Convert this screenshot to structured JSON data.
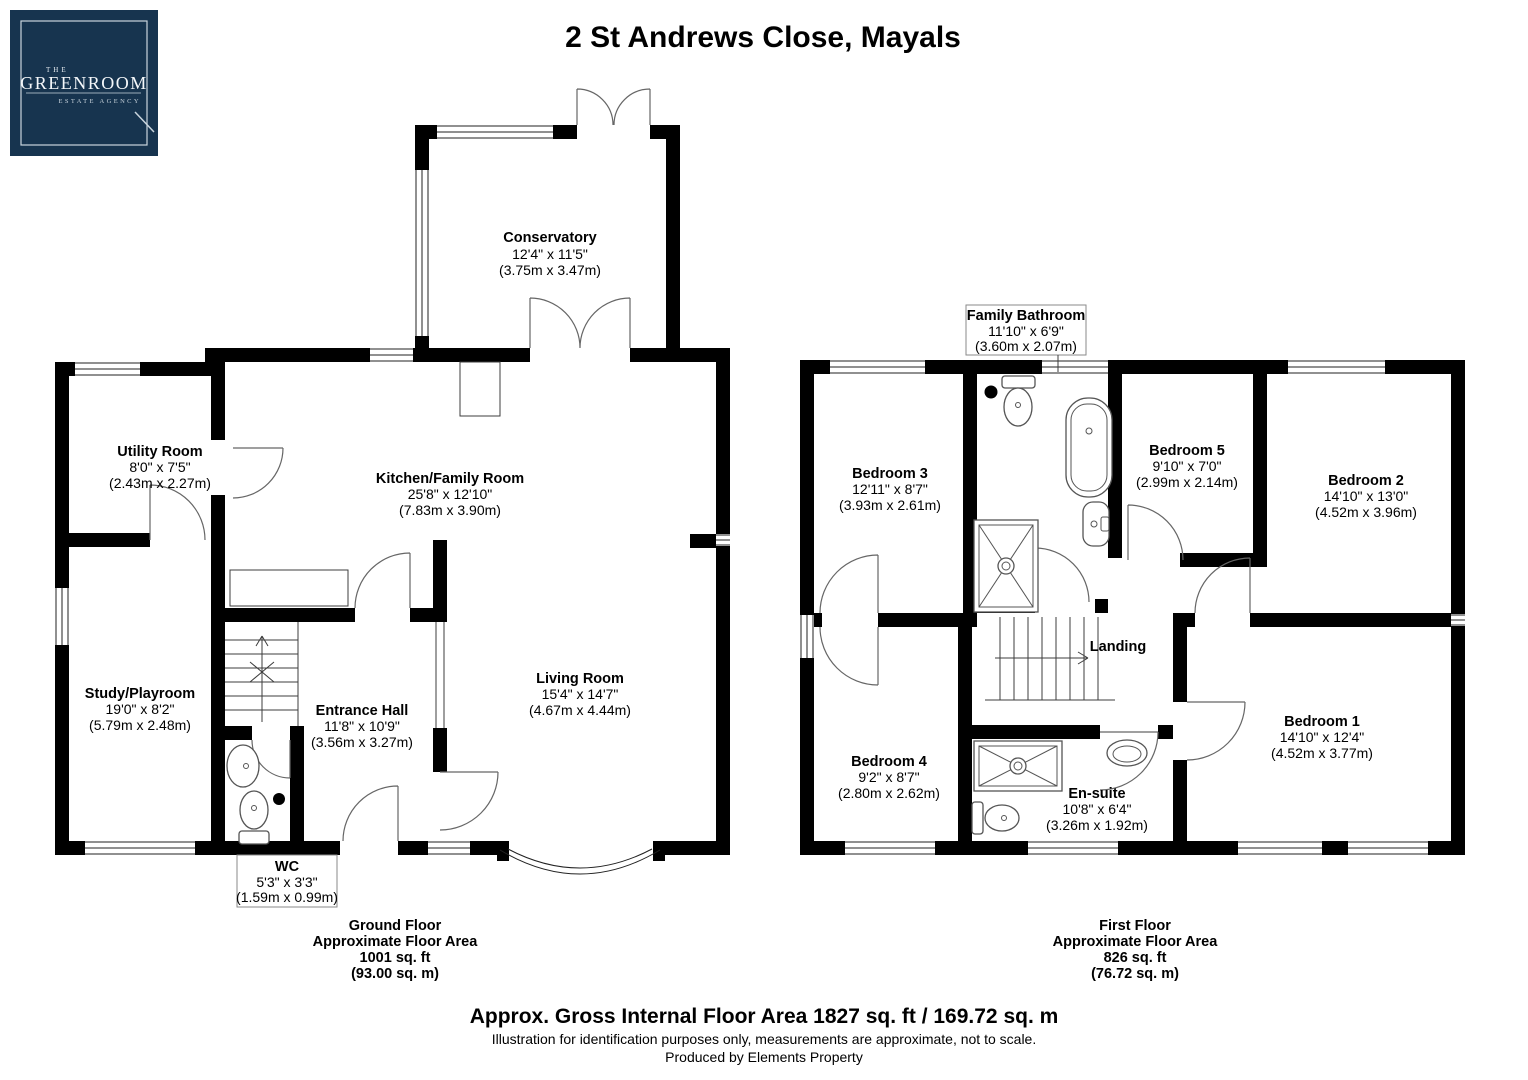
{
  "header": {
    "title": "2 St Andrews Close, Mayals",
    "logo": {
      "line1": "THE",
      "line2": "GREENROOM",
      "line3": "ESTATE AGENCY"
    }
  },
  "colors": {
    "logo_bg": "#17344f",
    "wall": "#000000",
    "accent_line": "#c9d4dd"
  },
  "ground_floor": {
    "rooms": {
      "conservatory": {
        "name": "Conservatory",
        "imperial": "12'4\" x 11'5\"",
        "metric": "(3.75m x 3.47m)"
      },
      "utility": {
        "name": "Utility Room",
        "imperial": "8'0\" x 7'5\"",
        "metric": "(2.43m x 2.27m)"
      },
      "kitchen": {
        "name": "Kitchen/Family Room",
        "imperial": "25'8\" x 12'10\"",
        "metric": "(7.83m x 3.90m)"
      },
      "study": {
        "name": "Study/Playroom",
        "imperial": "19'0\" x 8'2\"",
        "metric": "(5.79m x 2.48m)"
      },
      "entrance": {
        "name": "Entrance Hall",
        "imperial": "11'8\" x 10'9\"",
        "metric": "(3.56m x 3.27m)"
      },
      "living": {
        "name": "Living Room",
        "imperial": "15'4\" x 14'7\"",
        "metric": "(4.67m x 4.44m)"
      },
      "wc": {
        "name": "WC",
        "imperial": "5'3\" x 3'3\"",
        "metric": "(1.59m x 0.99m)"
      }
    },
    "area": {
      "line1": "Ground Floor",
      "line2": "Approximate Floor Area",
      "line3": "1001 sq. ft",
      "line4": "(93.00 sq. m)"
    }
  },
  "first_floor": {
    "rooms": {
      "bathroom": {
        "name": "Family Bathroom",
        "imperial": "11'10\" x 6'9\"",
        "metric": "(3.60m x 2.07m)"
      },
      "bedroom3": {
        "name": "Bedroom 3",
        "imperial": "12'11\" x 8'7\"",
        "metric": "(3.93m x 2.61m)"
      },
      "bedroom5": {
        "name": "Bedroom 5",
        "imperial": "9'10\" x 7'0\"",
        "metric": "(2.99m x 2.14m)"
      },
      "bedroom2": {
        "name": "Bedroom 2",
        "imperial": "14'10\" x 13'0\"",
        "metric": "(4.52m x 3.96m)"
      },
      "landing": {
        "name": "Landing"
      },
      "bedroom4": {
        "name": "Bedroom 4",
        "imperial": "9'2\" x 8'7\"",
        "metric": "(2.80m x 2.62m)"
      },
      "ensuite": {
        "name": "En-suite",
        "imperial": "10'8\" x 6'4\"",
        "metric": "(3.26m x 1.92m)"
      },
      "bedroom1": {
        "name": "Bedroom 1",
        "imperial": "14'10\" x 12'4\"",
        "metric": "(4.52m x 3.77m)"
      }
    },
    "area": {
      "line1": "First Floor",
      "line2": "Approximate Floor Area",
      "line3": "826 sq. ft",
      "line4": "(76.72 sq. m)"
    }
  },
  "footer": {
    "gross": "Approx. Gross Internal Floor Area 1827 sq. ft / 169.72 sq. m",
    "disclaimer": "Illustration for identification purposes only, measurements are approximate, not to scale.",
    "credit": "Produced by Elements Property"
  }
}
